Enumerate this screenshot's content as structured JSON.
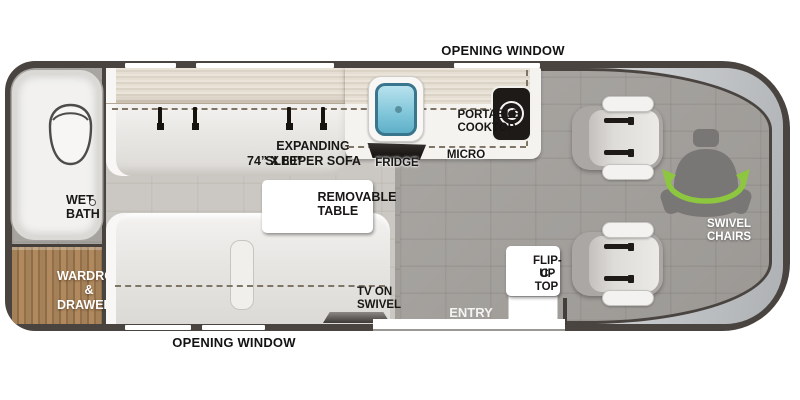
{
  "colors": {
    "wall": "#4a4441",
    "floor_gray": "#a4a19d",
    "floor_light": "#cbc8c3",
    "counter_beige": "#e3dccf",
    "wood": "#9c7b52",
    "sofa": "#e9e7e4",
    "sink_blue": "#84c8db",
    "cooktop_black": "#1e1a18",
    "windshield": "#c9cccf",
    "accent_green": "#8dc63f",
    "label_black": "#181715",
    "label_white": "#ffffff"
  },
  "labels": {
    "opening_window_top": "OPENING WINDOW",
    "opening_window_bottom": "OPENING WINDOW",
    "wet_bath": {
      "line1": "WET",
      "line2": "BATH"
    },
    "wardrobe": {
      "line1": "WARDROBE",
      "line2": "& DRAWERS"
    },
    "sleeper_sofa": {
      "line1": "EXPANDING SLEEPER SOFA",
      "line2": "74” X 80”"
    },
    "removable_table": {
      "line1": "REMOVABLE",
      "line2": "TABLE"
    },
    "portable_cooktop": {
      "line1": "PORTABLE",
      "line2": "COOKTOP"
    },
    "fridge": "FRIDGE",
    "micro": "MICRO",
    "tv_on_swivel": {
      "line1": "TV ON",
      "line2": "SWIVEL"
    },
    "flip_up_ctop": {
      "line1": "FLIP-UP",
      "line2": "C-TOP"
    },
    "entry": "ENTRY",
    "swivel_chairs": {
      "line1": "SWIVEL",
      "line2": "CHAIRS"
    }
  }
}
